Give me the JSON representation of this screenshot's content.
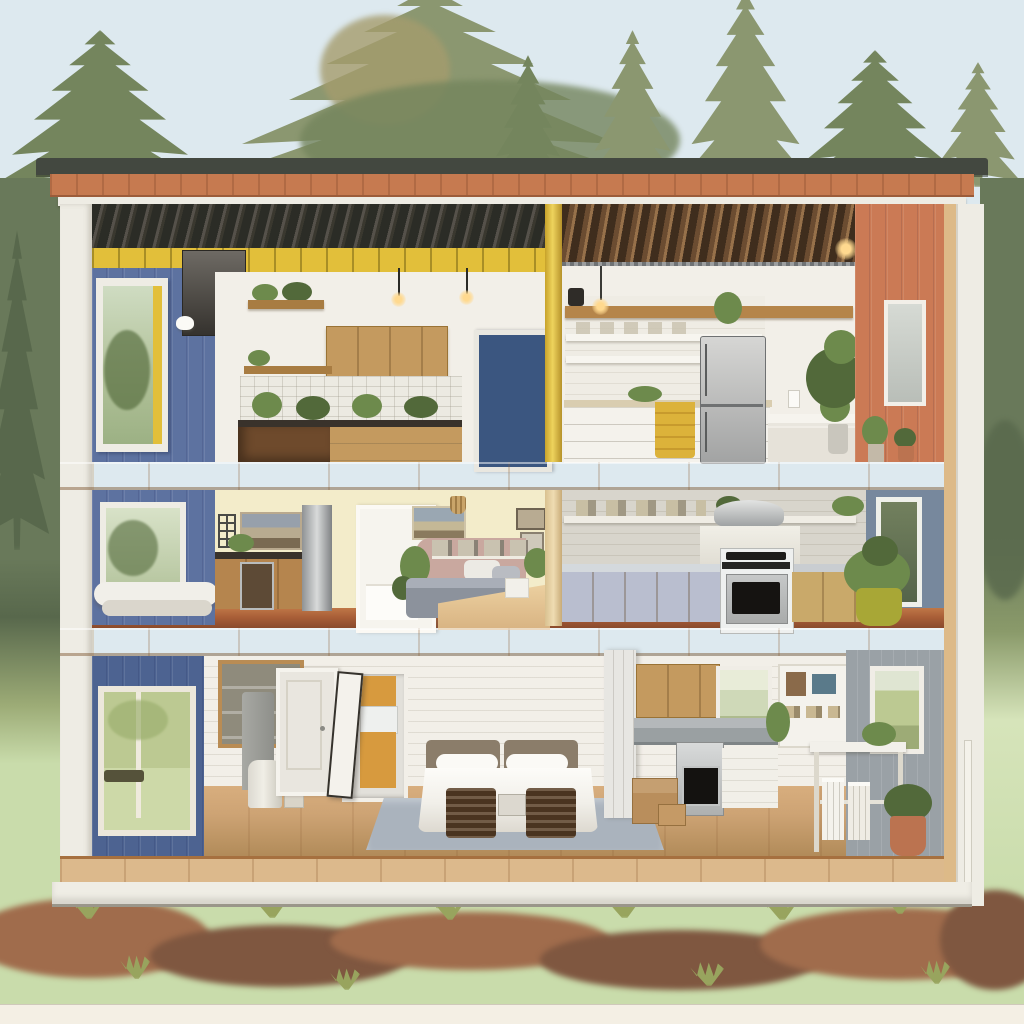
{
  "scene": {
    "type": "dollhouse-cutaway-illustration",
    "subject": "three-story modern cabin cross-section",
    "setting": "pine forest clearing with meadow and scrub foreground",
    "text_visible": "none",
    "floors": [
      {
        "level": "top",
        "rooms": [
          "loft-kitchenette-with-oak-cabinets",
          "white-kitchen-with-fridge"
        ],
        "accents": [
          "blue-left-wall",
          "blue-door",
          "yellow-post",
          "terracotta-right-wall",
          "yellow-towel"
        ]
      },
      {
        "level": "middle",
        "rooms": [
          "oak-kitchen-with-steel-column",
          "pale-yellow-lounge-bedroom",
          "gray-kitchen-with-range-hood"
        ],
        "accents": [
          "pink-half-wall",
          "slate-right-wall",
          "chartreuse-planter"
        ]
      },
      {
        "level": "bottom",
        "rooms": [
          "utility-entry-with-doors",
          "bedroom-with-white-bed",
          "oak-kitchen-dining"
        ],
        "accents": [
          "orange-closet",
          "gray-rug",
          "terracotta-planter"
        ]
      }
    ],
    "exterior": [
      "flat-dark-roof-cap",
      "terracotta-wood-fascia",
      "white-corner-posts",
      "plywood-floor-plates",
      "white-foundation"
    ]
  },
  "palette": {
    "sky": "#dde9ef",
    "treeOlive": "#8b9770",
    "treeDeep": "#74855d",
    "treeWarm": "#a59c6d",
    "bgTree": "#69795a",
    "bgTreeDark": "#58684c",
    "meadow": "#c9dcab",
    "meadowLight": "#d6e4ba",
    "scrub": "#a06c4c",
    "scrubDark": "#7f5740",
    "tuft": "#98a45e",
    "bottomStrip": "#f4efe4",
    "roofCap": "#434840",
    "fascia": "#c67a50",
    "fasciaEdge": "#9c5c3a",
    "trim": "#eeece4",
    "plyLight": "#f0dcb0",
    "plyMid": "#ddba88",
    "plyDark": "#c0946a",
    "blueWall": "#5d72a0",
    "blueWallDeep": "#4d6391",
    "blueDoor": "#3b5680",
    "yellowAccent": "#e2bf3a",
    "creamWall": "#f3ecca",
    "whiteWall": "#f2efe8",
    "orangeWall": "#cb7a55",
    "grayWall": "#9aa1a6",
    "slateWall": "#77889d",
    "oak": "#c49a5f",
    "oakDeep": "#a87c42",
    "woodDark": "#6e4a2c",
    "counterDark": "#39322b",
    "steelLight": "#d3d4d3",
    "steelDark": "#8f9293",
    "floorRed": "#a95f38",
    "floorRedDark": "#8a4a2c",
    "floorOak": "#cda374",
    "floorOakDark": "#b08a58",
    "deck": "#dcb98c",
    "rug": "#aab3bd",
    "ceilDark": "#2b2c26",
    "ceilDarkHi": "#55514a",
    "ceilBrown": "#6b4c31",
    "ceilBrownHi": "#97714a",
    "pinkWall": "#c9a89f",
    "bedGray": "#8c929c",
    "headboard": "#8b7d6a",
    "benchWood": "#4a3420",
    "duvet": "#f1efe9",
    "glassGreen": "#b2c29a",
    "fieldGreen": "#bcc992",
    "leaf": "#6d8a4c",
    "leafDeep": "#52693a",
    "towel": "#dcb23a",
    "potChartreuse": "#a8a736",
    "terracotta": "#bb7350",
    "bulb": "#ffd98f"
  }
}
